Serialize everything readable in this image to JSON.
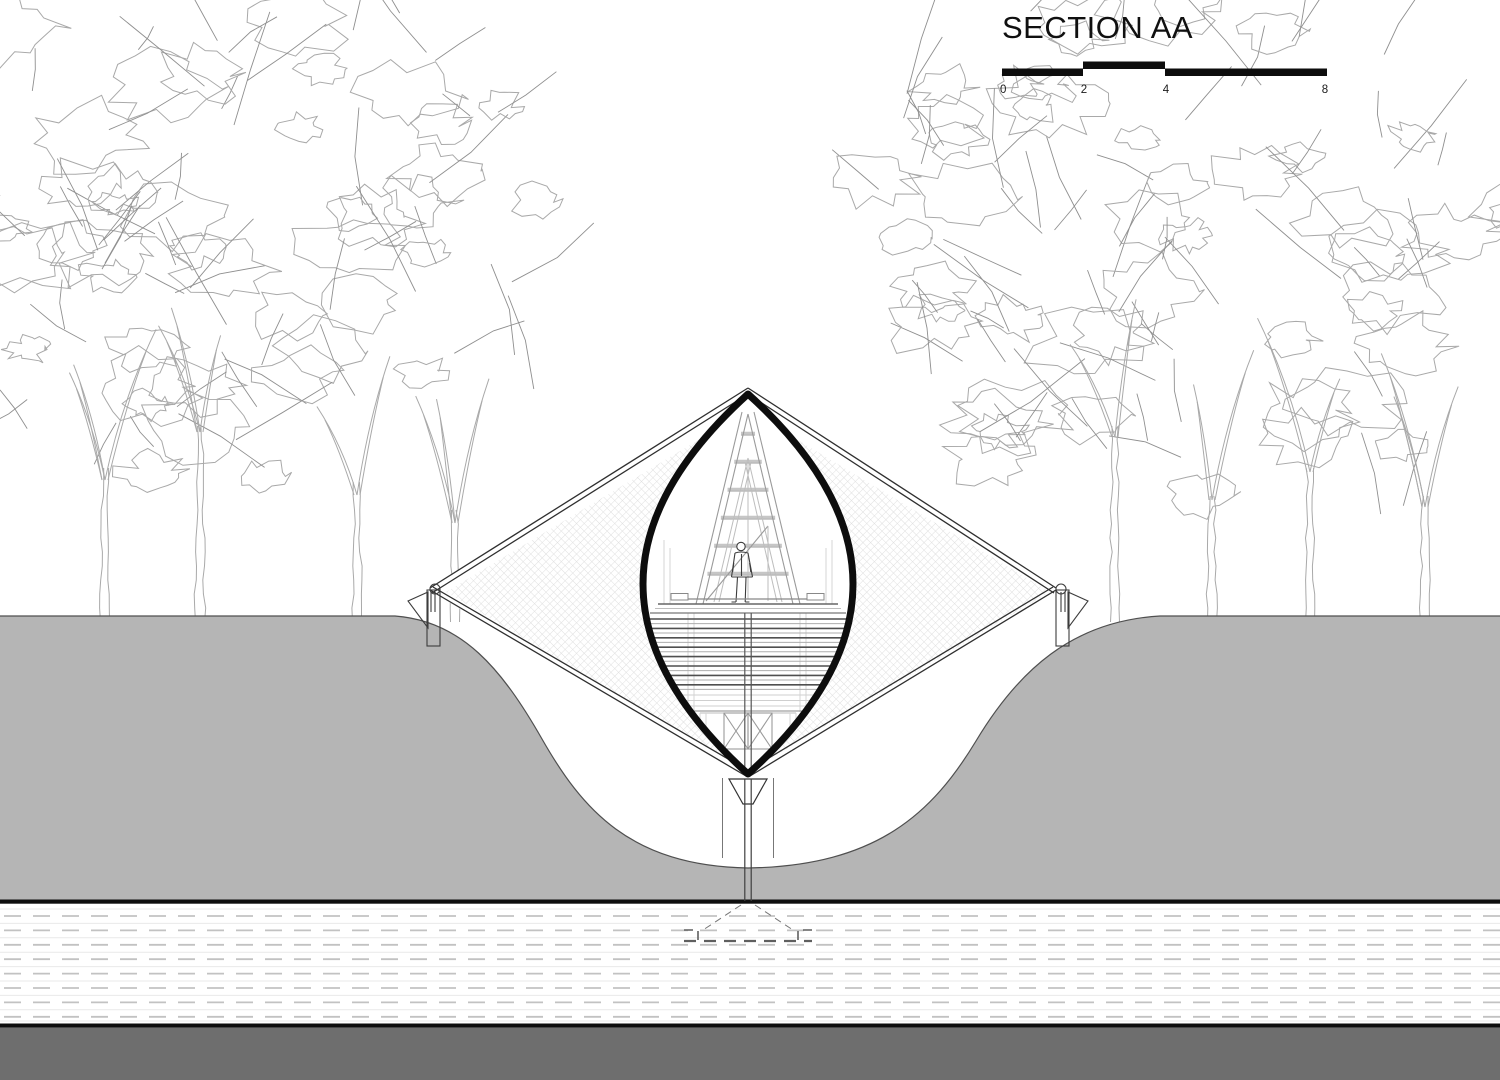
{
  "title": "SECTION AA",
  "scale_bar": {
    "labels": [
      "0",
      "2",
      "4",
      "8"
    ]
  },
  "colors": {
    "background": "#ffffff",
    "tree_line": "#a9a9a9",
    "branch_line": "#8f8f8f",
    "ground_fill": "#b5b5b5",
    "ground_edge": "#4f4f4f",
    "section_black": "#0d0d0d",
    "mesh_line": "#dfdfdf",
    "substrate_dash": "#c2c2c2",
    "substrate_solid": "#e9e9e9",
    "base_band": "#6e6e6e"
  }
}
